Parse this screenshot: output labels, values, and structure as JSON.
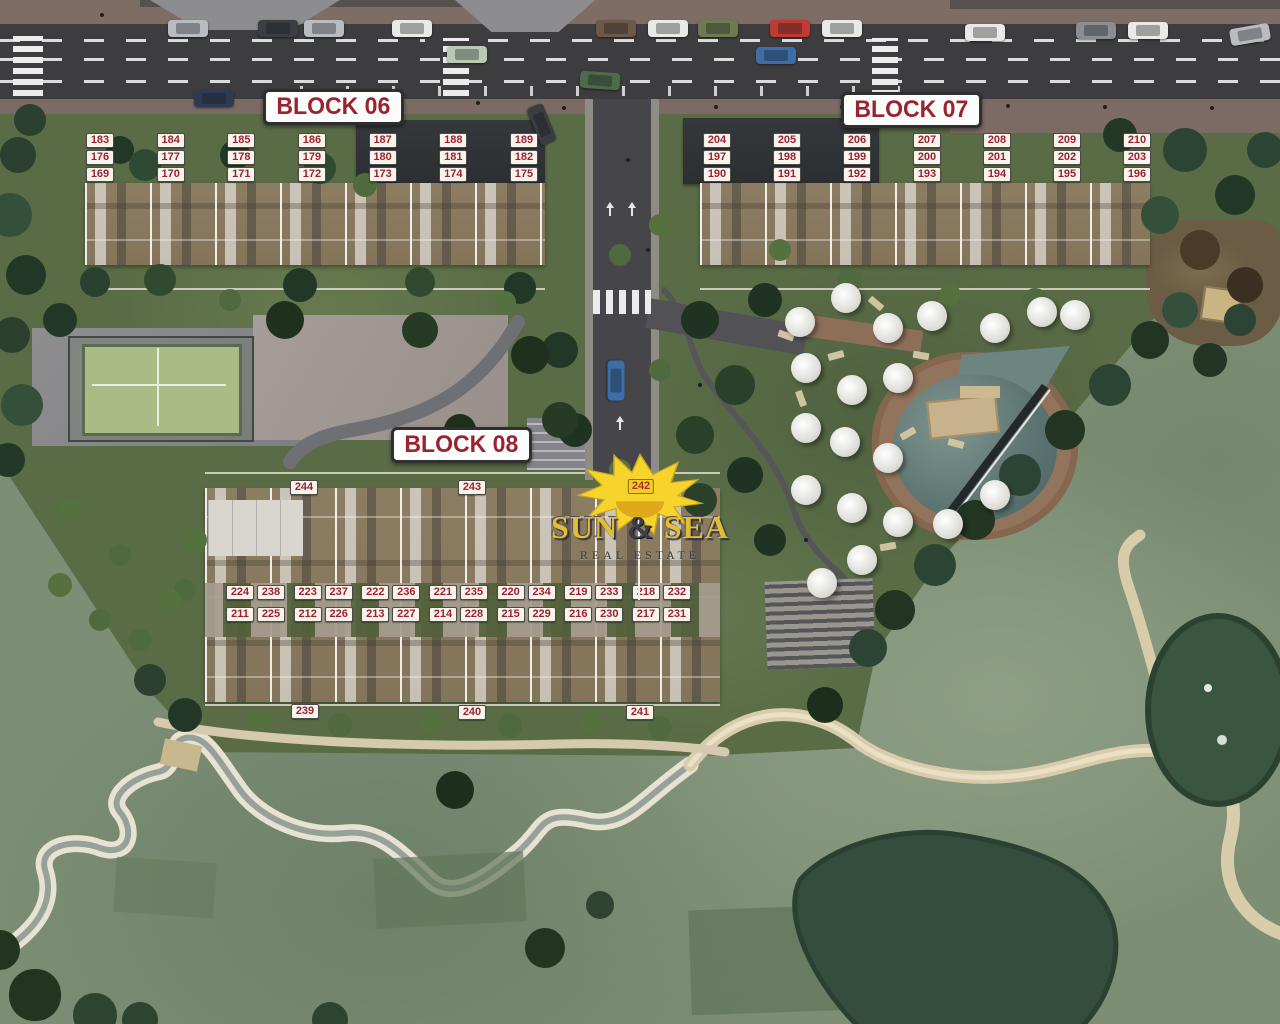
{
  "brand": {
    "word1": "SUN",
    "amp": "&",
    "word2": "SEA",
    "tagline": "REAL ESTATE"
  },
  "blocks": {
    "b06": {
      "label": "BLOCK 06",
      "rows": [
        [
          "183",
          "184",
          "185",
          "186",
          "187",
          "188",
          "189"
        ],
        [
          "176",
          "177",
          "178",
          "179",
          "180",
          "181",
          "182"
        ],
        [
          "169",
          "170",
          "171",
          "172",
          "173",
          "174",
          "175"
        ]
      ]
    },
    "b07": {
      "label": "BLOCK 07",
      "rows": [
        [
          "204",
          "205",
          "206",
          "207",
          "208",
          "209",
          "210"
        ],
        [
          "197",
          "198",
          "199",
          "200",
          "201",
          "202",
          "203"
        ],
        [
          "190",
          "191",
          "192",
          "193",
          "194",
          "195",
          "196"
        ]
      ]
    },
    "b08": {
      "label": "BLOCK 08",
      "top": [
        "244",
        "243"
      ],
      "sun_unit": "242",
      "mid": [
        [
          [
            "224",
            "238"
          ],
          [
            "223",
            "237"
          ],
          [
            "222",
            "236"
          ],
          [
            "221",
            "235"
          ],
          [
            "220",
            "234"
          ],
          [
            "219",
            "233"
          ],
          [
            "218",
            "232"
          ]
        ],
        [
          [
            "211",
            "225"
          ],
          [
            "212",
            "226"
          ],
          [
            "213",
            "227"
          ],
          [
            "214",
            "228"
          ],
          [
            "215",
            "229"
          ],
          [
            "216",
            "230"
          ],
          [
            "217",
            "231"
          ]
        ]
      ],
      "bottom": [
        "239",
        "240",
        "241"
      ]
    }
  },
  "colors": {
    "badge_text": "#9b2231",
    "badge_bg": "#f8f4ec",
    "label_text": "#9b2231",
    "sun_yellow": "#f6d42c",
    "logo_text": "#e3bd35",
    "tagline_text": "#343a3e",
    "asphalt": "#3d3d40",
    "sidewalk": "#7b6b64",
    "site_lawn": "#5a6c46",
    "golf_green": "#7c8f75",
    "pool_water": "#5d7472",
    "pool_deck": "#92735b",
    "building_roof": "#8d7d62"
  }
}
